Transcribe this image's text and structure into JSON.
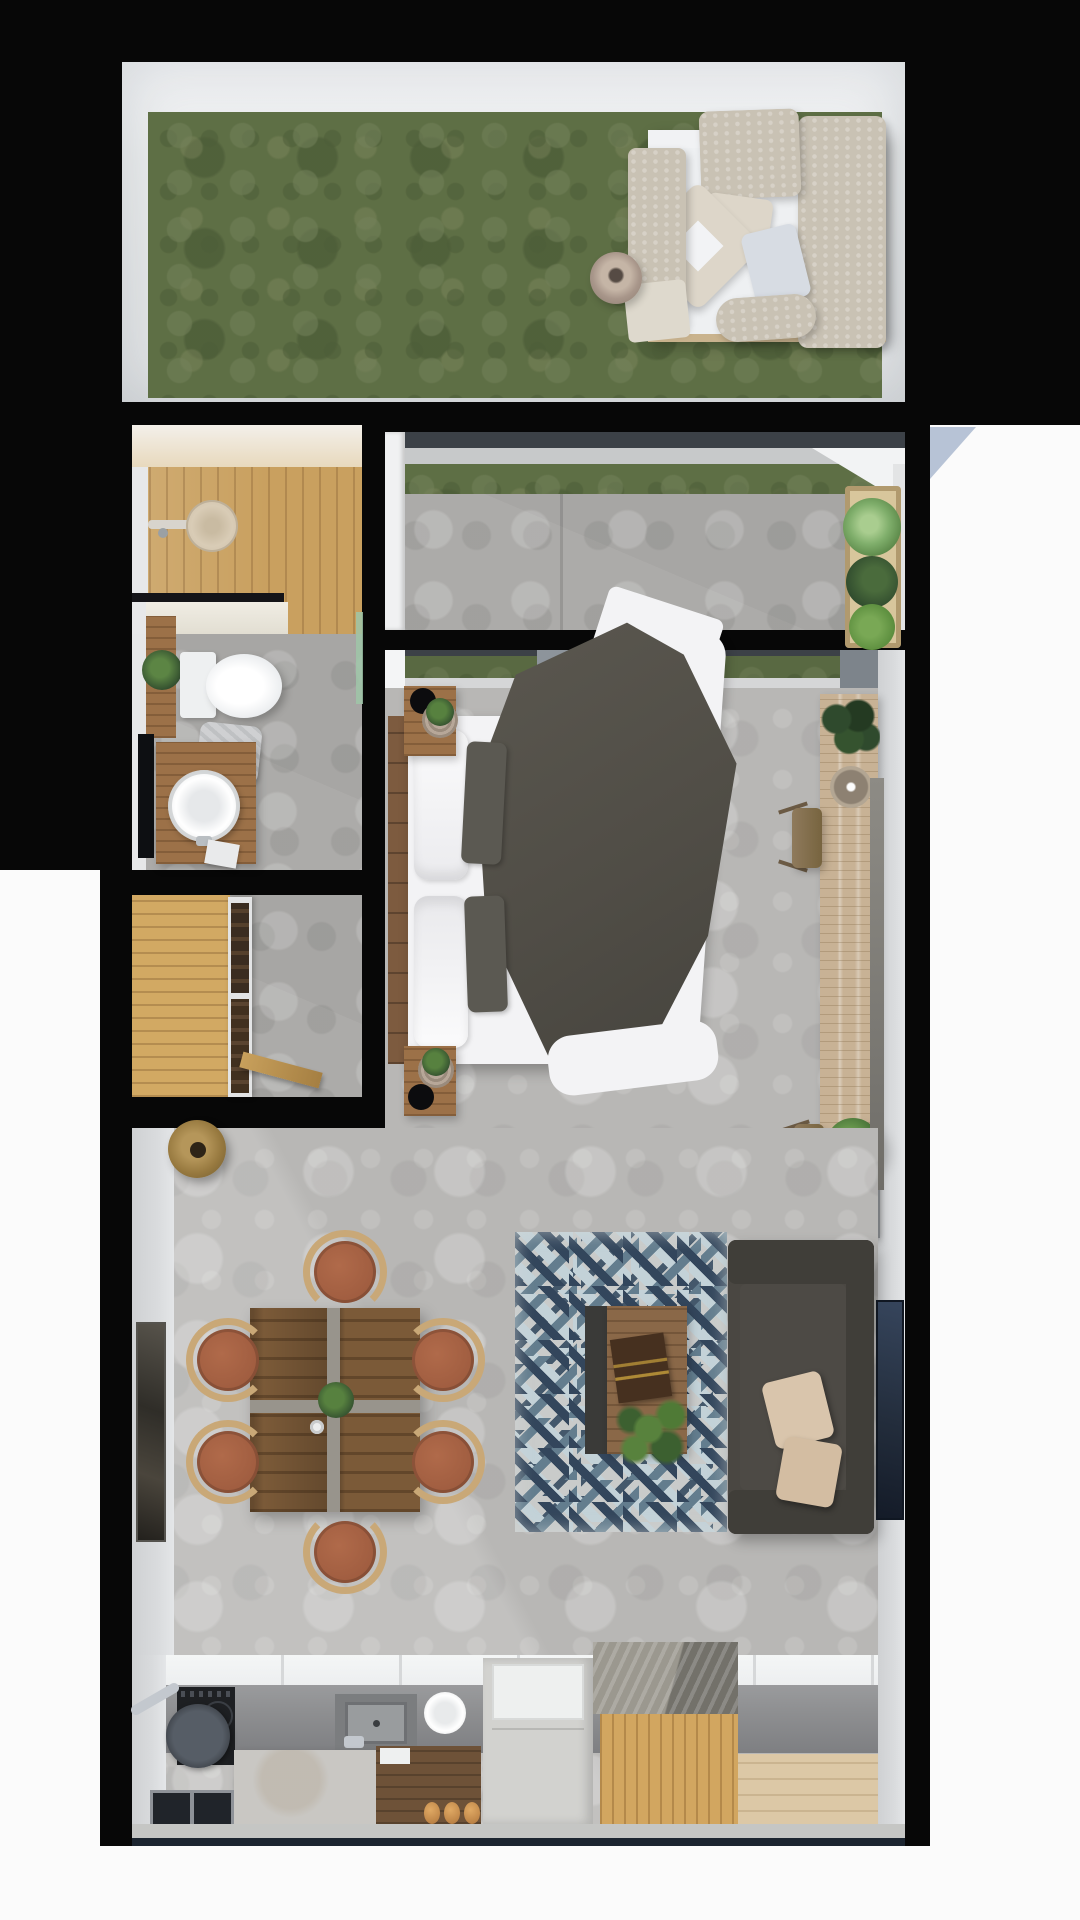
{
  "meta": {
    "type": "floor-plan",
    "view": "top-down-3d-render",
    "canvas_w": 1080,
    "canvas_h": 1920,
    "description": "Rendered top view of a studio apartment with garden terrace, covered balcony, bathroom, closet, bedroom, living-dining area and kitchen"
  },
  "colors": {
    "bg": "#070707",
    "exterior": "#fbfbfb",
    "wedge": "#b7c3d6",
    "wallFace": "#e9ebec",
    "wallWarm": "#eee4cf",
    "wallBand": "#d9dbdd",
    "grass": "#5e6f45",
    "concrete": "#a7a6a4",
    "concreteLight": "#b8b7b5",
    "woodLight": "#c9a05f",
    "woodCloset": "#d2a963",
    "woodWarm": "#9c7148",
    "headboard": "#7d5b3f",
    "woodDesk": "#c8b295",
    "woodTable": "#7b5a38",
    "woodCoffee": "#8a6848",
    "woodIsland": "#d2a660",
    "woodWalnut": "#6e5238",
    "woodEntry": "#dcc8a6",
    "bedWhite": "#f3f3f5",
    "blanket": "#55524b",
    "sofa": "#4a4742",
    "sofaDark": "#403e39",
    "beige": "#c9c2b4",
    "beigeLight": "#ddd6c9",
    "pillowBeige": "#d9c5ac",
    "terracotta": "#a05d40",
    "chairWood": "#c9a877",
    "rugNavy": "#33465c",
    "rugSlate": "#637d8e",
    "rugPale": "#c3d2d8",
    "rugGray": "#c9cbca",
    "rugTeal": "#44586b",
    "counter": "#8e8f91",
    "cooktop": "#1e2023",
    "steel": "#c3c8ce",
    "island": "#c9c7c3",
    "fridge": "#d2d2cf",
    "tile": "#edeff0",
    "bronze": "#97793f",
    "bronzeDark": "#2e2417",
    "plant": "#4e7a3c",
    "plantDark": "#2f4a2d",
    "plantLight": "#7fae6b",
    "planterWood": "#d8c69c",
    "white": "#f4f5f6",
    "frameDark": "#3b3a36",
    "framePic": "#232d3c",
    "windowFrame": "#3c4147",
    "sill": "#c7c9ca",
    "mullion": "#8d949b",
    "glassGreen": "#9fc6a8",
    "grate": "#20242a",
    "stone": "#9b988f"
  },
  "rooms": [
    {
      "id": "garden",
      "name": "Garden terrace",
      "floor": "grass",
      "furniture": [
        "outdoor-lounge-sofa",
        "lounge-cushions",
        "decor-vase"
      ]
    },
    {
      "id": "balcony",
      "name": "Covered terrace",
      "floor": "concrete",
      "furniture": [
        "planter-box-with-plants"
      ]
    },
    {
      "id": "bathroom",
      "name": "Bathroom",
      "floor": "wood+concrete",
      "furniture": [
        "walk-in-shower",
        "toilet",
        "vanity-vessel-sink",
        "wall-shelf-plant",
        "towel",
        "mirror"
      ]
    },
    {
      "id": "closet",
      "name": "Entry closet",
      "floor": "wood+concrete",
      "furniture": [
        "wardrobe-unit",
        "leaning-plank"
      ]
    },
    {
      "id": "bedroom",
      "name": "Bedroom",
      "floor": "concrete",
      "furniture": [
        "double-bed",
        "headboard",
        "nightstand-top",
        "nightstand-bottom",
        "wall-desk",
        "stool-1",
        "stool-2",
        "tv-panel",
        "desk-plants",
        "pendant-bowl",
        "books"
      ]
    },
    {
      "id": "living",
      "name": "Living-dining",
      "floor": "concrete",
      "furniture": [
        "dining-table",
        "dining-chairs-x6",
        "area-rug",
        "coffee-table",
        "sofa",
        "throw-pillows",
        "wall-art-left",
        "wall-art-right",
        "pendant-lamp",
        "table-plant",
        "coffee-table-plant",
        "book"
      ]
    },
    {
      "id": "kitchen",
      "name": "Kitchen",
      "floor": "concrete+wood",
      "furniture": [
        "cooktop",
        "frying-pan",
        "sink",
        "plate",
        "island-counter",
        "walnut-cabinet",
        "bread-rolls",
        "fridge",
        "butcher-block-cube",
        "floor-grate",
        "entry-wood-floor"
      ]
    }
  ]
}
